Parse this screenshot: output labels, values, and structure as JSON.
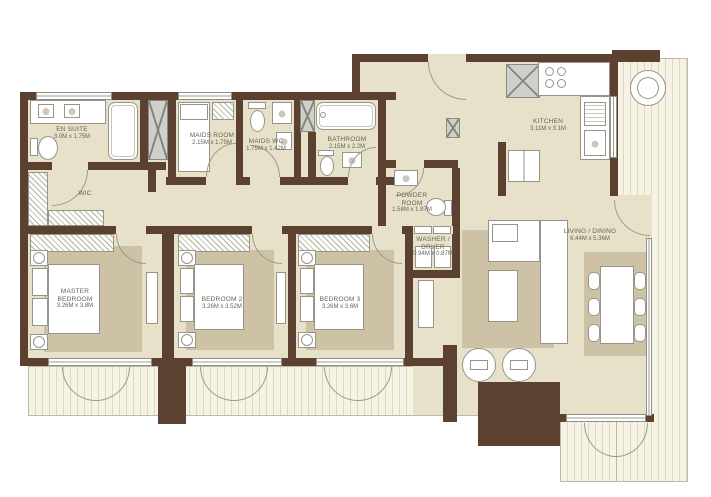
{
  "rooms": {
    "en_suite": {
      "name": "EN SUITE",
      "dims": "3.0M x 1.75M"
    },
    "wic": {
      "name": "WIC",
      "dims": ""
    },
    "maids_room": {
      "name": "MAIDS ROOM",
      "dims": "2.15M x 1.75M"
    },
    "maids_wc": {
      "name": "MAIDS WC",
      "dims": "1.75M x 1.42M"
    },
    "bathroom": {
      "name": "BATHROOM",
      "dims": "2.15M x 2.2M"
    },
    "powder_room": {
      "name": "POWDER ROOM",
      "dims": "1.58M x 1.97M"
    },
    "kitchen": {
      "name": "KITCHEN",
      "dims": "3.11M x 3.1M"
    },
    "washer_dryer": {
      "name": "WASHER / DRYER",
      "dims": "0.94M x 0.87M"
    },
    "living_dining": {
      "name": "LIVING / DINING",
      "dims": "6.44M x 5.36M"
    },
    "master_bedroom": {
      "name": "MASTER BEDROOM",
      "dims": "3.26M x 3.8M"
    },
    "bedroom_2": {
      "name": "BEDROOM 2",
      "dims": "3.26M x 3.52M"
    },
    "bedroom_3": {
      "name": "BEDROOM 3",
      "dims": "3.26M x 3.6M"
    }
  },
  "colors": {
    "wall": "#5d4130",
    "floor": "#e8e1ca",
    "rug": "#cdc2a5",
    "balcony_deck": "#f6f3e4",
    "fixture_stroke": "#95958a",
    "shaft_fill": "#cfcfcb",
    "label_text": "#63635c"
  }
}
